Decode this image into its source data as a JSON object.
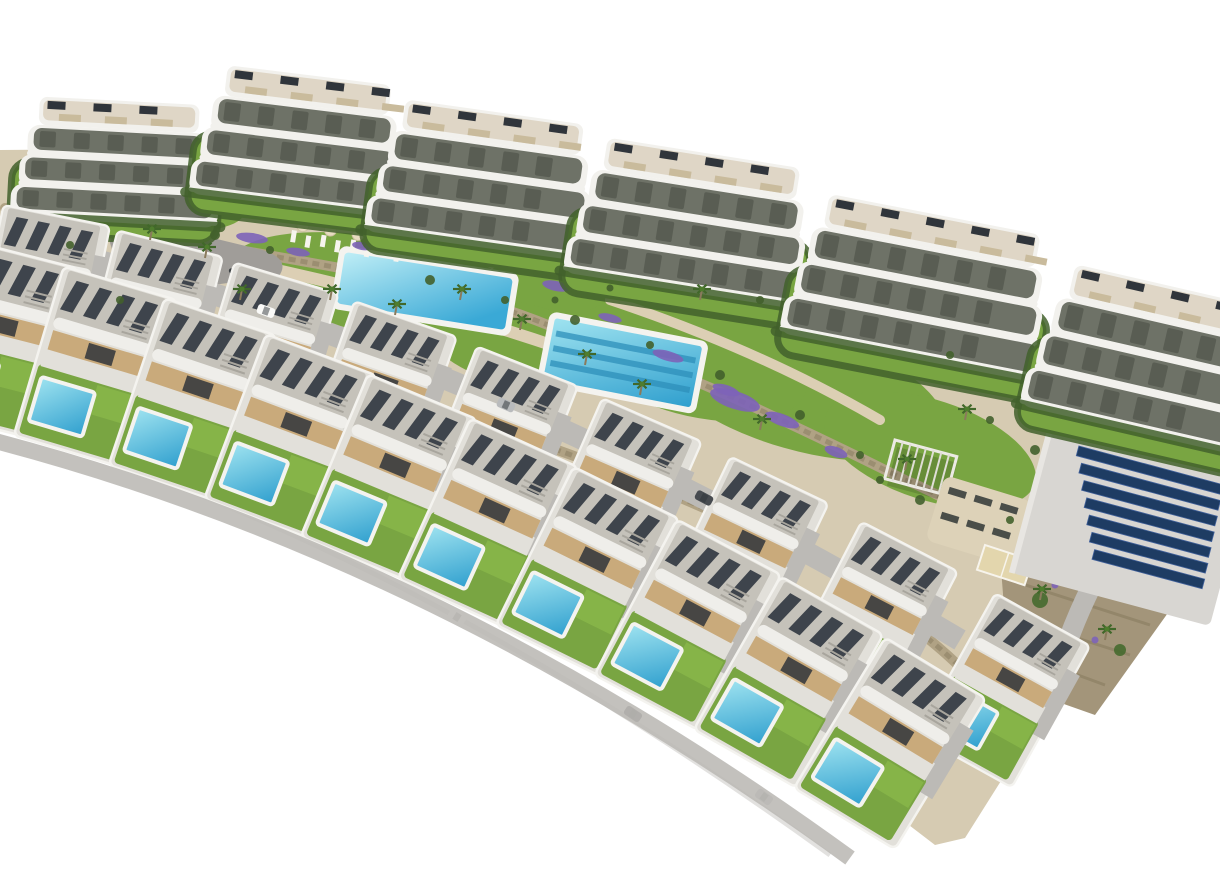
{
  "image": {
    "description": "Aerial 3D architectural render of a hillside residential development on a white background: a curved back row of white apartment blocks with wavy wrap-around balconies, two staggered diagonal rows of modern flat-roof villas each with a private turquoise pool, communal amenity gardens with a rectangular pool, a lane-striped lap pool, playground plaza, pergola, sun-lounger decks and a photovoltaic solar panel field at the right.",
    "width_px": 1220,
    "height_px": 870
  },
  "palette": {
    "background": "#ffffff",
    "terrain_sand": "#d6cbb2",
    "lawn": "#79a542",
    "lawn_bright": "#8cba4c",
    "hedge": "#42602c",
    "stone_wall": "#b0a284",
    "stone_wall_dark": "#93866a",
    "path_sand": "#dccfb4",
    "road": "#bcbab6",
    "road_dark": "#a9a7a3",
    "building_white": "#f2f1ed",
    "building_shadow": "#d7d5cf",
    "balcony_interior": "#6e7267",
    "balcony_dark": "#484c44",
    "roof_terrace": "#d9d0bc",
    "roof_item_dark": "#30353b",
    "roof_item_tan": "#c9bb9c",
    "villa_roof": "#c5c2ba",
    "villa_roof_edge": "#efeeea",
    "villa_slat": "#3e444c",
    "villa_wall_tan": "#c9aa7b",
    "villa_terrace": "#e2e0da",
    "pool_light": "#9fe3f0",
    "pool_deep": "#2f9fce",
    "pool_rim": "#f4f3ef",
    "lap_lane": "#2e8fb9",
    "lavender": "#7d63b8",
    "palm_green": "#41682a",
    "palm_trunk": "#8a7a5c",
    "playground": "#a09d99",
    "toy_yellow": "#e2bc3c",
    "toy_red": "#c05240",
    "solar_panel": "#1e3c63",
    "solar_frame": "#41619b",
    "solar_apron": "#d8d6d2",
    "sand_court": "#e3d6ad",
    "lounger_dark": "#4a4e49",
    "lounger_light": "#f6f4ee",
    "umbrella": "#e7dcc0",
    "hillside": "#a3957a",
    "car_white": "#fafaf8",
    "car_dark": "#474b50",
    "car_silver": "#b9bbbd",
    "shadow_edge": "#dbdad7"
  },
  "scene": {
    "apartment_buildings": {
      "count": 6,
      "balcony_floors": 3,
      "style": "curved white wrap-around balconies with rooftop terraces and AC units"
    },
    "villas": {
      "rows": 2,
      "front_row_count": 10,
      "back_row_count": 9,
      "features": "gravel flat roof with dark solar slats, tan facade band, terrace, lawn and private turquoise pool with white rim"
    },
    "amenities": {
      "communal_pool": "rectangular turquoise pool with parasols and sun loungers",
      "lap_pool": "long lap pool with lane stripes",
      "lap_pool_lanes": 3,
      "playground": "grey paved play plaza with yellow and red play equipment",
      "pergola": "white slatted pergola on lawn",
      "solar_array_rows": 7,
      "sand_deck": "sand court with dark sun loungers",
      "volleyball_court": "small sand court"
    },
    "landscape": {
      "palm_count": 15,
      "lavender_bed_count": 15,
      "stone_wall_count": 6,
      "parked_car_count": 6,
      "roads": "internal curved streets between villa rows"
    }
  }
}
